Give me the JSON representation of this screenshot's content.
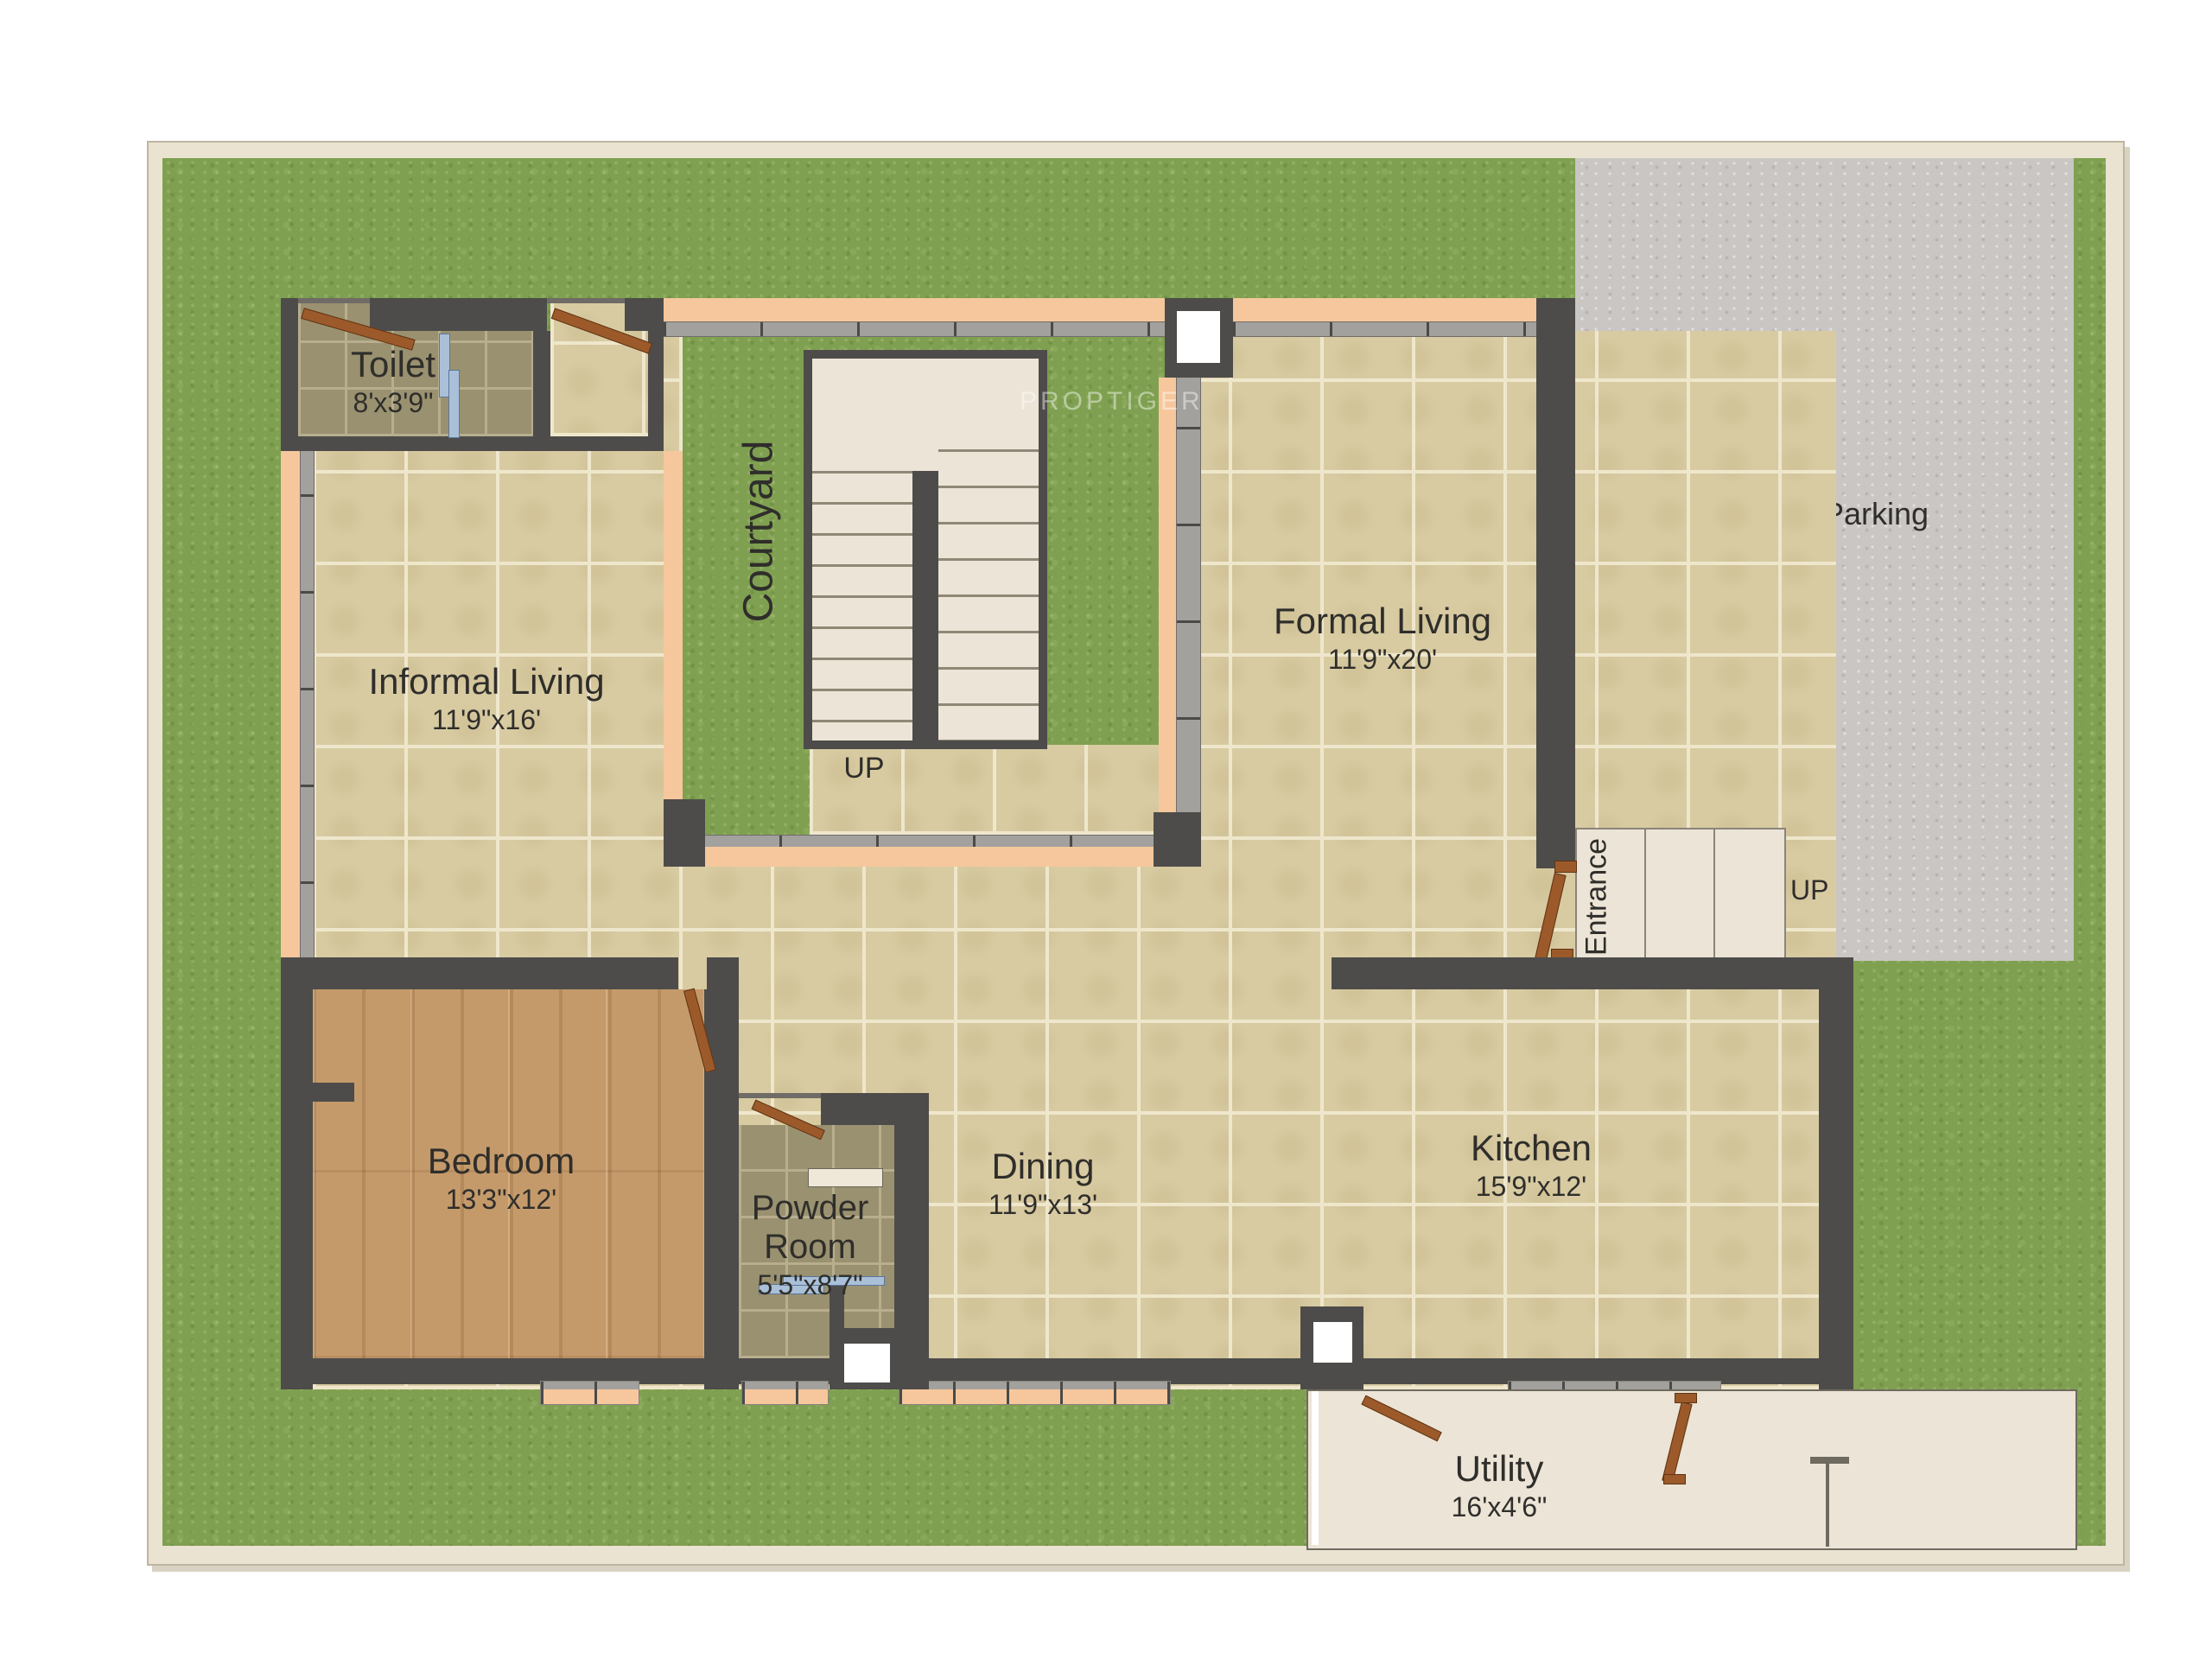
{
  "watermark": {
    "text": "PROPTIGER"
  },
  "zones": {
    "parking": {
      "label": "Covered Car Parking"
    },
    "courtyard": {
      "label": "Courtyard"
    },
    "entrance": {
      "label": "Entrance"
    },
    "stairs_up": {
      "label": "UP"
    },
    "parking_up": {
      "label": "UP"
    }
  },
  "rooms": {
    "toilet": {
      "name": "Toilet",
      "dims": "8'x3'9\""
    },
    "informal_living": {
      "name": "Informal Living",
      "dims": "11'9\"x16'"
    },
    "formal_living": {
      "name": "Formal Living",
      "dims": "11'9\"x20'"
    },
    "bedroom": {
      "name": "Bedroom",
      "dims": "13'3\"x12'"
    },
    "powder_room": {
      "name": "Powder Room",
      "dims": "5'5\"x8'7\""
    },
    "dining": {
      "name": "Dining",
      "dims": "11'9\"x13'"
    },
    "kitchen": {
      "name": "Kitchen",
      "dims": "15'9\"x12'"
    },
    "utility": {
      "name": "Utility",
      "dims": "16'x4'6\""
    }
  },
  "colors": {
    "plotbg": "#eae3d2",
    "grass": "#7fa050",
    "floor": "#d8cba2",
    "grout": "#efe7cc",
    "wall": "#4d4c4a",
    "peach": "#f6c79c",
    "olive": "#9a9170",
    "olivegrout": "#b8ae8e",
    "wood": "#c59a6b",
    "parking": "#c9c6c3",
    "cream": "#ece4d6",
    "stair": "#ece4d6",
    "door": "#9c5a2a",
    "fixture": "#a9c0d8",
    "ink": "#2f2e2b"
  }
}
